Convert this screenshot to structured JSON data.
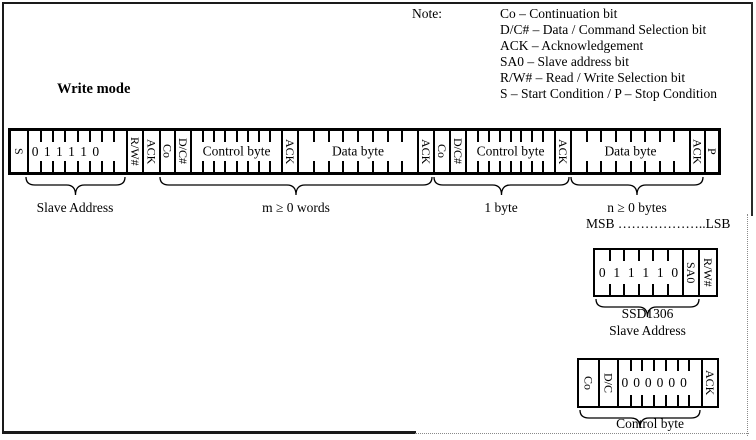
{
  "note": {
    "label": "Note:",
    "lines": [
      "Co – Continuation bit",
      "D/C# – Data / Command Selection bit",
      "ACK – Acknowledgement",
      "SA0 – Slave address bit",
      "R/W# – Read / Write Selection bit",
      "S – Start Condition / P – Stop Condition"
    ]
  },
  "labels": {
    "write_mode": "Write mode",
    "slave_address": "Slave Address",
    "m_words": "m ≥ 0 words",
    "one_byte": "1 byte",
    "n_bytes": "n ≥ 0 bytes",
    "msb_lsb": "MSB ………………..LSB",
    "ssd1306": "SSD1306",
    "ssd1306_sub": "Slave Address",
    "control_byte_caption": "Control byte"
  },
  "frames": {
    "main": {
      "cells": [
        {
          "type": "rot",
          "label": "S",
          "w": 16
        },
        {
          "type": "bits",
          "label": "slave-address-bits",
          "digits": [
            "0",
            "1",
            "1",
            "1",
            "1",
            "0",
            "",
            ""
          ],
          "w": 99
        },
        {
          "type": "rot",
          "label": "R/W#",
          "w": 16
        },
        {
          "type": "rot",
          "label": "ACK",
          "w": 17
        },
        {
          "type": "rot",
          "label": "Co",
          "w": 15
        },
        {
          "type": "rot",
          "label": "D/C#",
          "w": 16
        },
        {
          "type": "field",
          "label": "Control byte",
          "slots": 8,
          "w": 91
        },
        {
          "type": "rot",
          "label": "ACK",
          "w": 16
        },
        {
          "type": "field",
          "label": "Data byte",
          "slots": 8,
          "w": 120
        },
        {
          "type": "rot",
          "label": "ACK",
          "w": 16
        },
        {
          "type": "rot",
          "label": "Co",
          "w": 16
        },
        {
          "type": "rot",
          "label": "D/C#",
          "w": 16
        },
        {
          "type": "field",
          "label": "Control byte",
          "slots": 8,
          "w": 89
        },
        {
          "type": "rot",
          "label": "ACK",
          "w": 16
        },
        {
          "type": "field",
          "label": "Data byte",
          "slots": 8,
          "w": 119
        },
        {
          "type": "rot",
          "label": "ACK",
          "w": 15
        },
        {
          "type": "rot",
          "label": "P",
          "w": 14
        }
      ]
    },
    "slave_box": {
      "cells": [
        {
          "type": "bits",
          "label": "ssd1306-address-bits",
          "digits": [
            "0",
            "1",
            "1",
            "1",
            "1",
            "0"
          ],
          "w": 87
        },
        {
          "type": "rot",
          "label": "SA0",
          "w": 16
        },
        {
          "type": "rot",
          "label": "R/W#",
          "w": 18
        }
      ]
    },
    "control_box": {
      "cells": [
        {
          "type": "rot",
          "label": "Co",
          "w": 19
        },
        {
          "type": "rot",
          "label": "D/C",
          "w": 19
        },
        {
          "type": "bits",
          "label": "control-byte-bits",
          "digits": [
            "0",
            "0",
            "0",
            "0",
            "0",
            "0",
            ""
          ],
          "w": 84
        },
        {
          "type": "rot",
          "label": "ACK",
          "w": 16
        }
      ]
    }
  },
  "colors": {
    "ink": "#000000",
    "page": "#ffffff",
    "dotted_border": "#8a8a8a"
  }
}
